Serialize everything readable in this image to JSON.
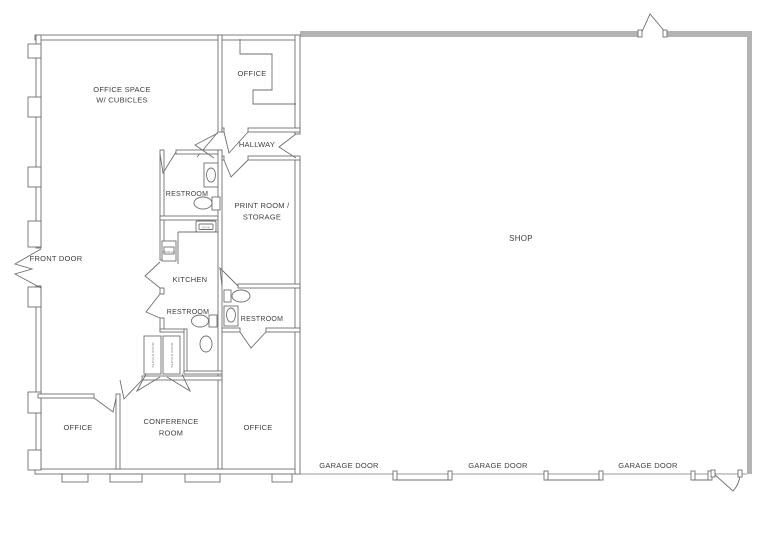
{
  "drawing": {
    "type": "floor-plan",
    "colors": {
      "background": "#ffffff",
      "interior_wall": "#6f6f6f",
      "shop_wall": "#b3b3b3",
      "text": "#3e3e3e"
    },
    "rooms": {
      "office_space": {
        "line1": "OFFICE SPACE",
        "line2": "W/ CUBICLES"
      },
      "office_top": {
        "label": "OFFICE"
      },
      "hallway": {
        "label": "HALLWAY"
      },
      "restroom_upper": {
        "label": "RESTROOM"
      },
      "print_room": {
        "line1": "PRINT ROOM /",
        "line2": "STORAGE"
      },
      "kitchen": {
        "label": "KITCHEN"
      },
      "restroom_mid": {
        "label": "RESTROOM"
      },
      "restroom_right": {
        "label": "RESTROOM"
      },
      "closet_left": {
        "label": "SERVER ROOM"
      },
      "closet_right": {
        "label": "SERVER ROOM"
      },
      "office_bottom_left": {
        "label": "OFFICE"
      },
      "conference": {
        "line1": "CONFERENCE",
        "line2": "ROOM"
      },
      "office_bottom": {
        "label": "OFFICE"
      },
      "shop": {
        "label": "SHOP"
      }
    },
    "doors": {
      "front": "FRONT DOOR",
      "garage1": "GARAGE DOOR",
      "garage2": "GARAGE DOOR",
      "garage3": "GARAGE DOOR"
    },
    "fixtures": {
      "kitchen_sink": "SINK",
      "kitchen_fridge": "FRIDGE"
    }
  }
}
